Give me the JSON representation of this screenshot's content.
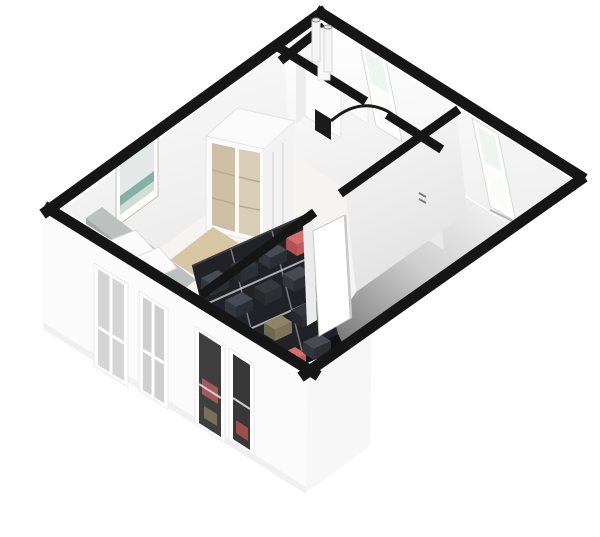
{
  "image": {
    "description": "3D isometric top-down render of a one-bedroom apartment floor plan",
    "view": "isometric-top",
    "background": "#ffffff"
  },
  "rooms": [
    {
      "name": "bedroom",
      "furniture": [
        "double-bed",
        "headboard",
        "pillows",
        "wardrobe",
        "rug",
        "picture-frame"
      ]
    },
    {
      "name": "utility-room",
      "furniture": [
        "boiler",
        "flue-pipes",
        "dark-door",
        "door-swing-arc",
        "shelf"
      ]
    },
    {
      "name": "living-room",
      "furniture": []
    },
    {
      "name": "walk-in-closet",
      "furniture": [
        "shelving-unit",
        "clothes-stacks"
      ]
    },
    {
      "name": "hallway",
      "furniture": [
        "open-white-door"
      ]
    }
  ],
  "windows": {
    "left_facade_count": 4,
    "left_facade_note": "two light glass, two dark showing closet clothes",
    "top_right_wall_count": 2
  },
  "counts": {
    "clothes_stacks": 16,
    "pillows": 2,
    "boiler_pipes": 2,
    "doors": 2
  },
  "colors": {
    "wall": "#161616",
    "facadeLeft": "#fbfbfb",
    "facadeRight": "#ffffff",
    "facadeShade": "#f0f0f0",
    "faceWhite": "#fefefe",
    "faceShade": "#e9e9e9",
    "floorBedroom": "#f5f4f2",
    "floorUtility": "#f3f3f3",
    "floorLivingLight": "#f4f4f4",
    "floorLivingDark": "#6a6a6a",
    "wallFaceDark": "#4f4f4f",
    "glassGray": "#d5d5d5",
    "glassGray2": "#cfcfcf",
    "glassDark": "#3f3f3f",
    "glassDark2": "#383838",
    "windowPaneGreen": "#eef4ef",
    "windowPaneBright": "#f9fcf8",
    "frameWhite": "#ffffff",
    "sill": "#b5b5b5",
    "rug": "#d7c6a4",
    "rugShade": "#c4ae85",
    "rugLight": "#e6d9ba",
    "headboardTop": "#bcc0bf",
    "headboardFront": "#a4a8a7",
    "bedding": "#ffffff",
    "beddingEdge": "#e6e6e6",
    "sheetFold": "#f1f1f1",
    "pillow": "#fbfbfb",
    "pictureFrame": "#fcfcfc",
    "pictureArt": "#e4e9e7",
    "pictureTeal": "#84b1a6",
    "pictureLower": "#d3dbd7",
    "wardrobe": "#fafafa",
    "wardrobeSide": "#f2f2f2",
    "wardrobeEdge": "#e1e1e1",
    "wardrobeGlassTan": "#cdbfa3",
    "wardrobeGlassTan2": "#d8cdb7",
    "boiler": "#fcfcfc",
    "boilerShade": "#ededed",
    "pipeFill": "#f4f4f4",
    "pipeRim": "#8f8f8f",
    "doorLeaf": "#ffffff",
    "doorLeafEdge": "#c8c8c8",
    "doorLeafBack": "#ebebeb",
    "darkDoor": "#1b1b1b",
    "closetFrame": "#202227",
    "closetBaseShadow": "#101114",
    "shelfLine": "#cfd1d3",
    "redPatch": "#a65a58",
    "redPatch2": "#9e4e4c",
    "olivePatch": "#77705a",
    "switchMark": "#7d7d7d",
    "clothes": {
      "dark": {
        "top": "#474c54",
        "left": "#33373d",
        "right": "#2b2e33"
      },
      "charcoal": {
        "top": "#35383d",
        "left": "#26282c",
        "right": "#2c2f34"
      },
      "red": {
        "top": "#d4706c",
        "left": "#b1504f",
        "right": "#c05b59"
      },
      "olive": {
        "top": "#8f8468",
        "left": "#6f6750",
        "right": "#7d745b"
      },
      "cream": {
        "top": "#d3ccb6",
        "left": "#b0a890",
        "right": "#c3bba3"
      }
    }
  }
}
